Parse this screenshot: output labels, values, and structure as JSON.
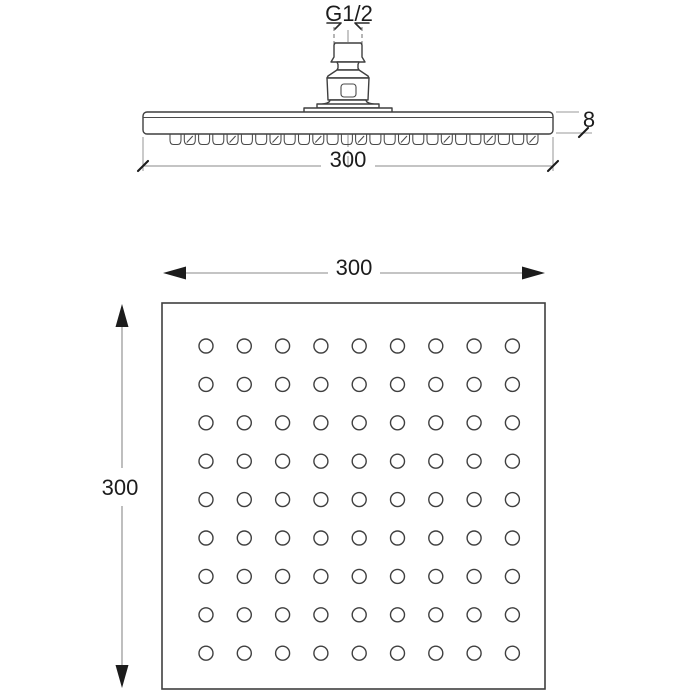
{
  "colors": {
    "background": "#ffffff",
    "line": "#3f3f3f",
    "dimension_line": "#8a8a8a",
    "text": "#1c1c1c"
  },
  "labels": {
    "thread_size": "G1/2",
    "side_view_width": "300",
    "side_view_thickness": "8",
    "face_view_width": "300",
    "face_view_height": "300"
  },
  "views": {
    "side": {
      "nozzle_count": 26
    },
    "face": {
      "grid": {
        "rows": 9,
        "cols": 9
      }
    }
  }
}
